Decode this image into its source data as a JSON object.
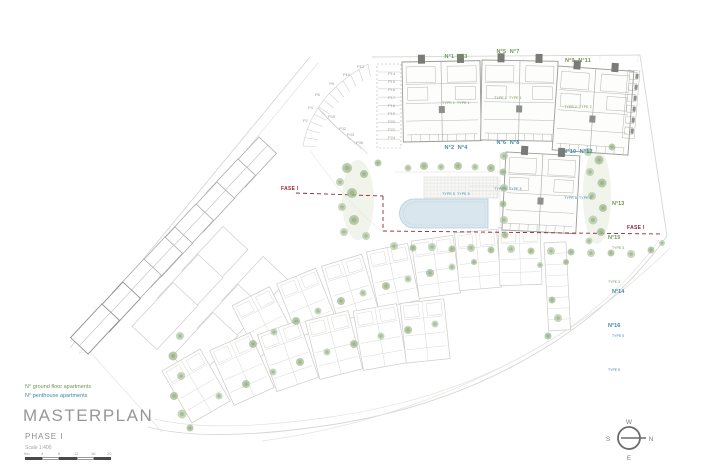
{
  "title_block": {
    "title": "MASTERPLAN",
    "phase": "PHASE I",
    "scale": "Scale 1:400"
  },
  "legend": {
    "ground": "N° ground floor apartments",
    "penthouse": "N° penthouse apartments"
  },
  "unit_groups": [
    {
      "ground_units": "N°1  N°3",
      "ground_types": "TYPE 1  TYPE 1",
      "penthouse_units": "N°2  N°4",
      "penthouse_types": "TYPE 5  TYPE 5"
    },
    {
      "ground_units": "N°5  N°7",
      "ground_types": "TYPE 1  TYPE 1",
      "penthouse_units": "N°6  N°8",
      "penthouse_types": "TYPE 5  TYPE 5"
    },
    {
      "ground_units": "N°9  N°11",
      "ground_types": "TYPE 2  TYPE 2",
      "penthouse_units": "N°10  N°12",
      "penthouse_types": "TYPE 5  TYPE 6"
    }
  ],
  "side_units": [
    {
      "no": "N°13",
      "type": "TYPE 3",
      "category": "ground"
    },
    {
      "no": "N°14",
      "type": "TYPE 5",
      "category": "penthouse"
    },
    {
      "no": "N°15",
      "type": "TYPE 3",
      "category": "ground"
    },
    {
      "no": "N°16",
      "type": "TYPE 5",
      "category": "penthouse"
    }
  ],
  "phase_labels": {
    "left": "FASE I",
    "right": "FASE I"
  },
  "parking": {
    "labels": [
      "P2",
      "P4",
      "P6",
      "P8",
      "P10",
      "P12",
      "P14",
      "P15",
      "P16",
      "P17",
      "P18",
      "P19",
      "P20",
      "P22",
      "P24",
      "P30",
      "P32",
      "P33",
      "P36"
    ]
  },
  "scalebar": {
    "labels": [
      "0m",
      "4",
      "8",
      "12",
      "16",
      "20"
    ]
  },
  "compass": {
    "top": "W",
    "left": "S",
    "right": "N",
    "bottom": "E"
  },
  "colors": {
    "ground": "#6f9655",
    "penthouse": "#3d89a8",
    "phase_line": "#8f2838",
    "pool": "#d9e6ee"
  }
}
